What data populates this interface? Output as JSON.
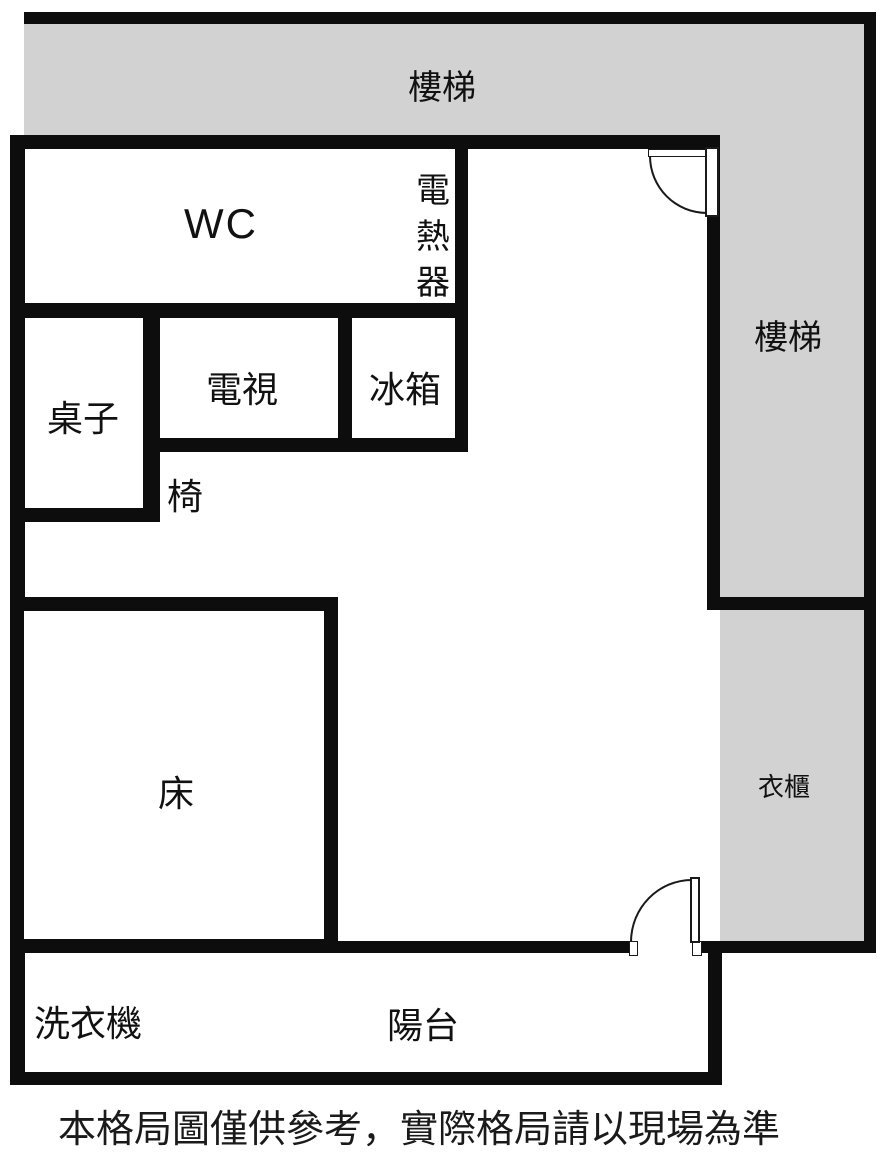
{
  "plan": {
    "stairs_top_label": "樓梯",
    "stairs_right_label": "樓梯",
    "wc_label": "WC",
    "water_heater_label": "電熱器",
    "desk_label": "桌子",
    "tv_label": "電視",
    "fridge_label": "冰箱",
    "chair_label": "椅",
    "bed_label": "床",
    "wardrobe_label": "衣櫃",
    "washer_label": "洗衣機",
    "balcony_label": "陽台"
  },
  "footer": {
    "disclaimer": "本格局圖僅供參考，實際格局請以現場為準"
  },
  "colors": {
    "wall": "#0d0d0d",
    "area_fill": "#d2d2d2",
    "background": "#ffffff",
    "door_line": "#1a1a1a"
  }
}
